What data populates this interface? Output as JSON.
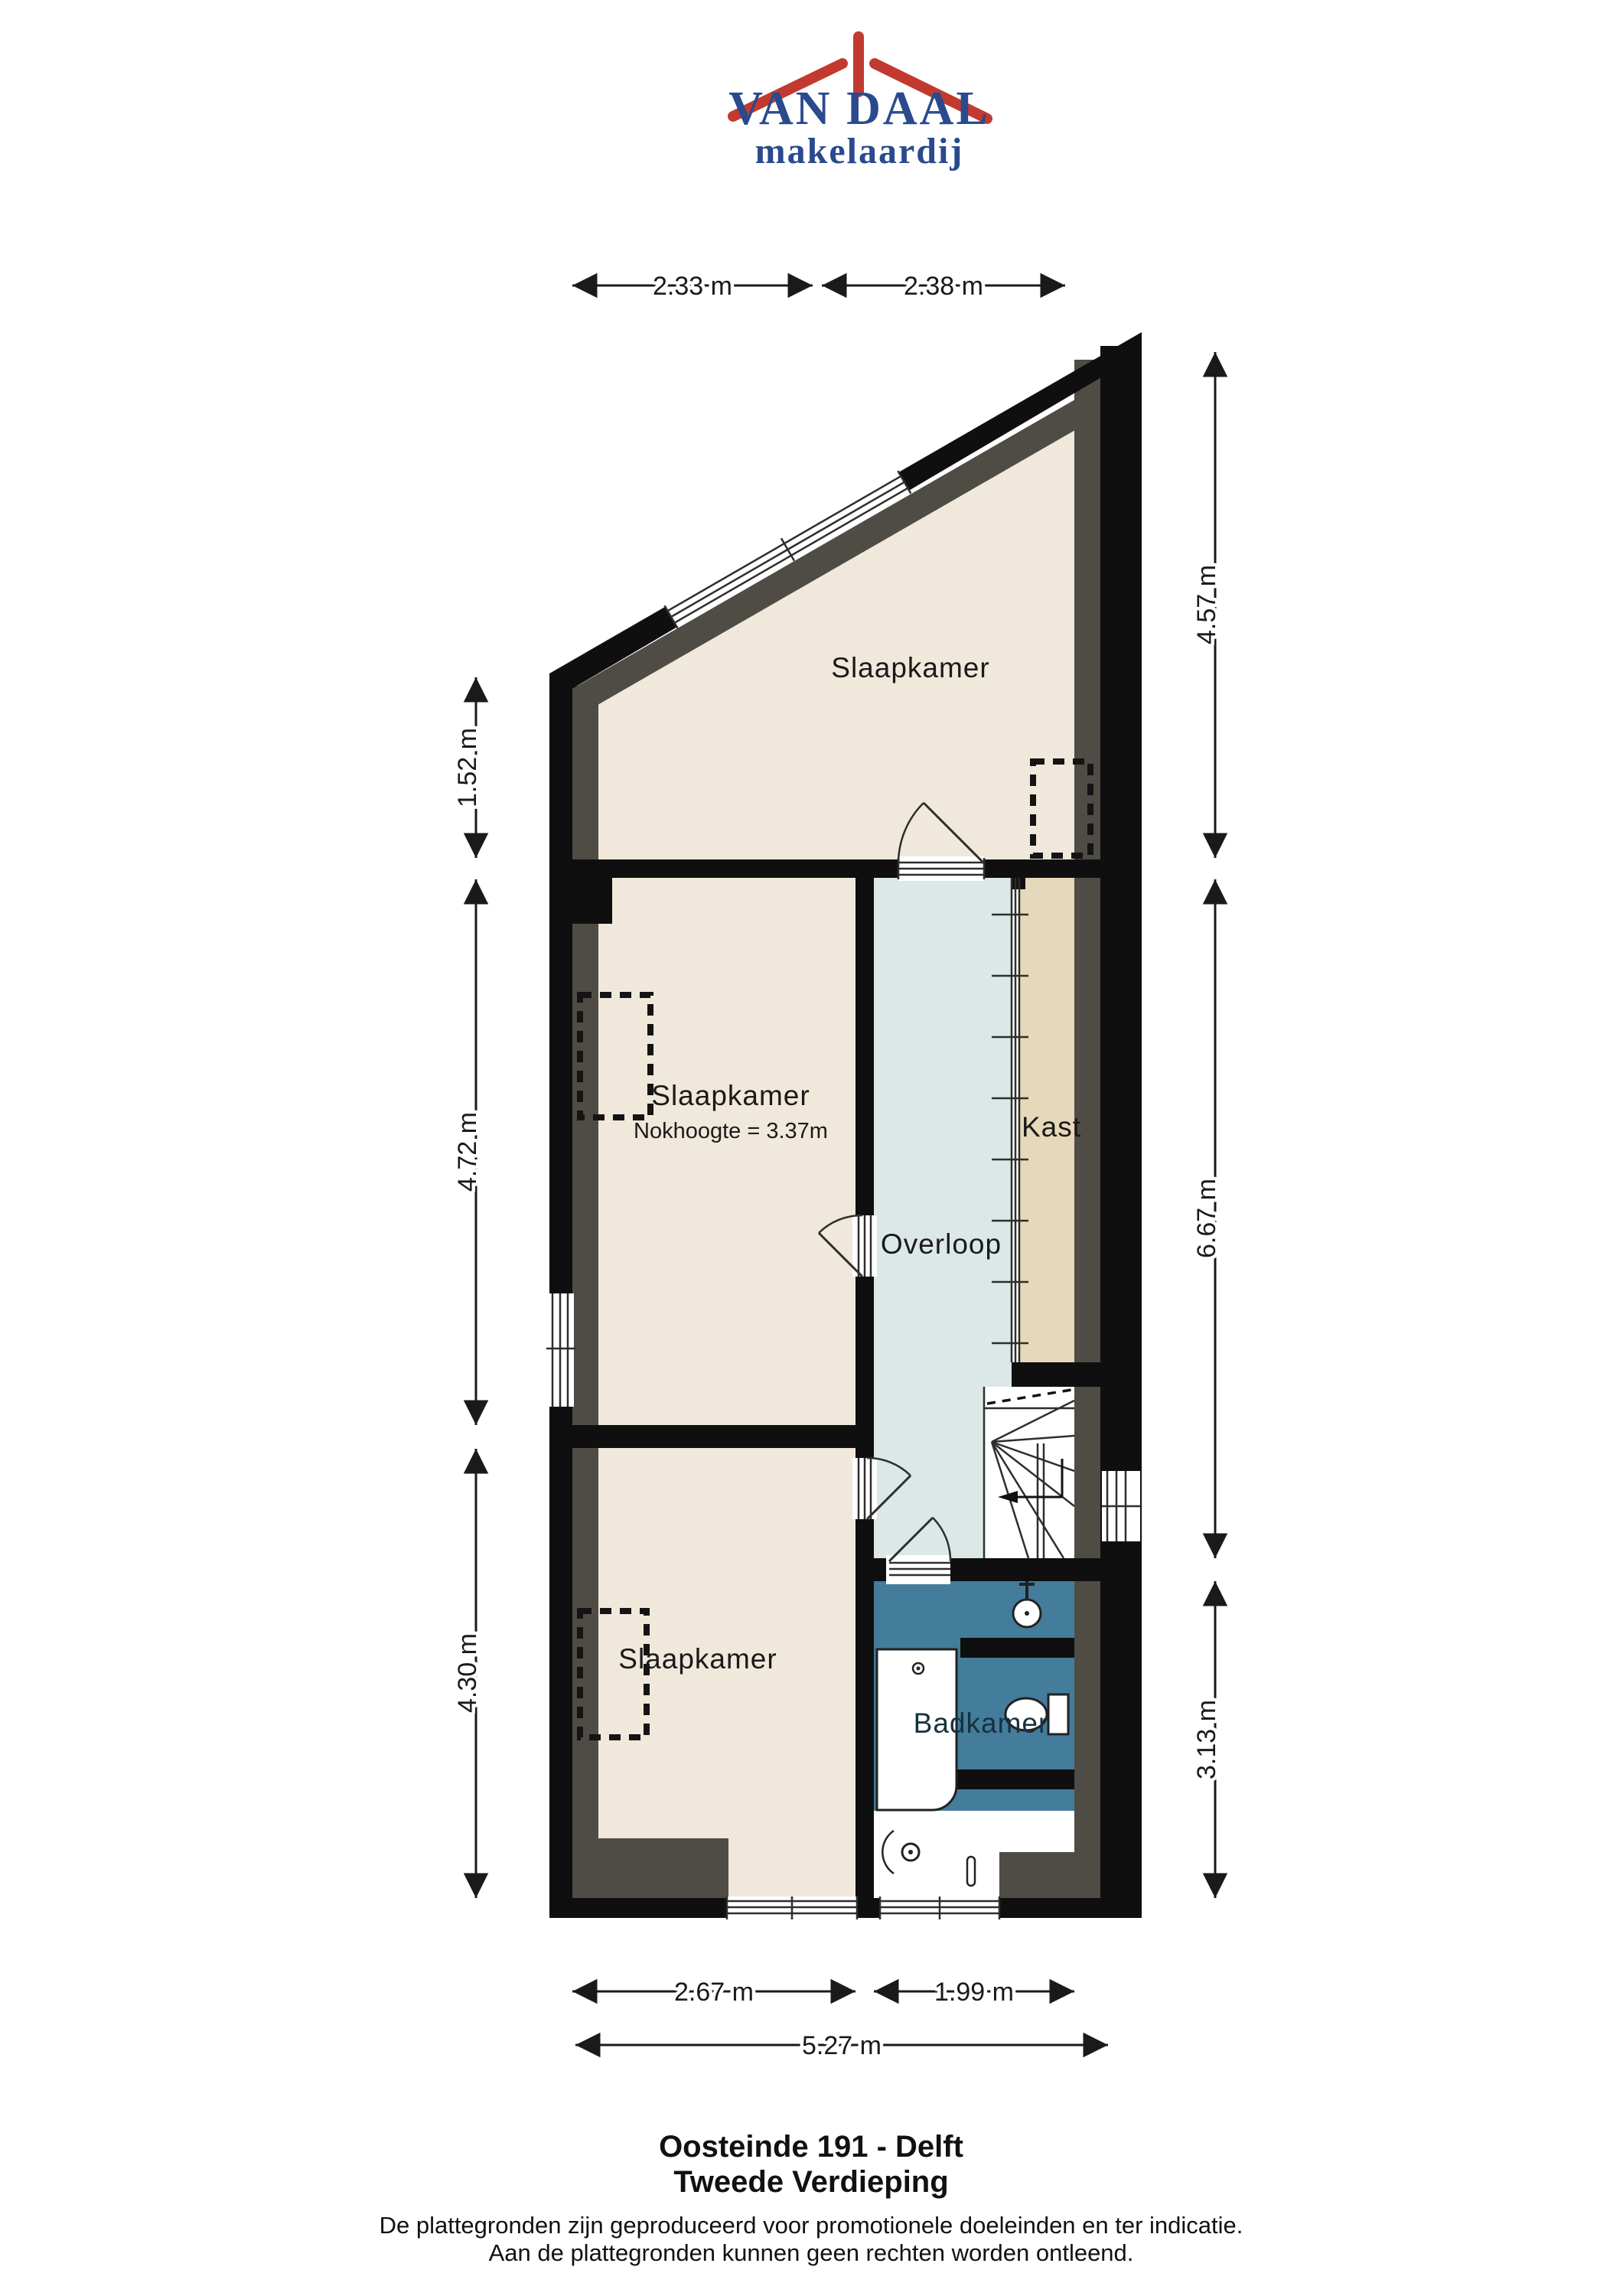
{
  "logo": {
    "brand": "VAN DAAL",
    "subtitle": "makelaardij",
    "red": "#c23a2f",
    "blue": "#2a4a8e"
  },
  "plan": {
    "rooms": [
      {
        "label": "Slaapkamer"
      },
      {
        "label": "Slaapkamer",
        "note": "Nokhoogte = 3.37m"
      },
      {
        "label": "Overloop"
      },
      {
        "label": "Kast"
      },
      {
        "label": "Badkamer"
      },
      {
        "label": "Slaapkamer"
      }
    ],
    "colors": {
      "floor": "#f0e8da",
      "overloop": "#dce8e7",
      "kast": "#e6d8ba",
      "badkamer": "#447c9c",
      "wall": "#0f0f0f",
      "slope": "#4f4b45",
      "white": "#ffffff"
    },
    "dimensions": {
      "top": [
        "2.33 m",
        "2.38 m"
      ],
      "left": [
        "1.52 m",
        "4.72 m",
        "4.30 m"
      ],
      "right": [
        "4.57 m",
        "6.67 m",
        "3.13 m"
      ],
      "bottom": [
        "2.67 m",
        "1.99 m",
        "5.27 m"
      ]
    }
  },
  "footer": {
    "address": "Oosteinde 191 - Delft",
    "floor": "Tweede Verdieping",
    "disclaimer_line1": "De plattegronden zijn geproduceerd voor promotionele doeleinden en ter indicatie.",
    "disclaimer_line2": "Aan de plattegronden kunnen geen rechten worden ontleend."
  }
}
